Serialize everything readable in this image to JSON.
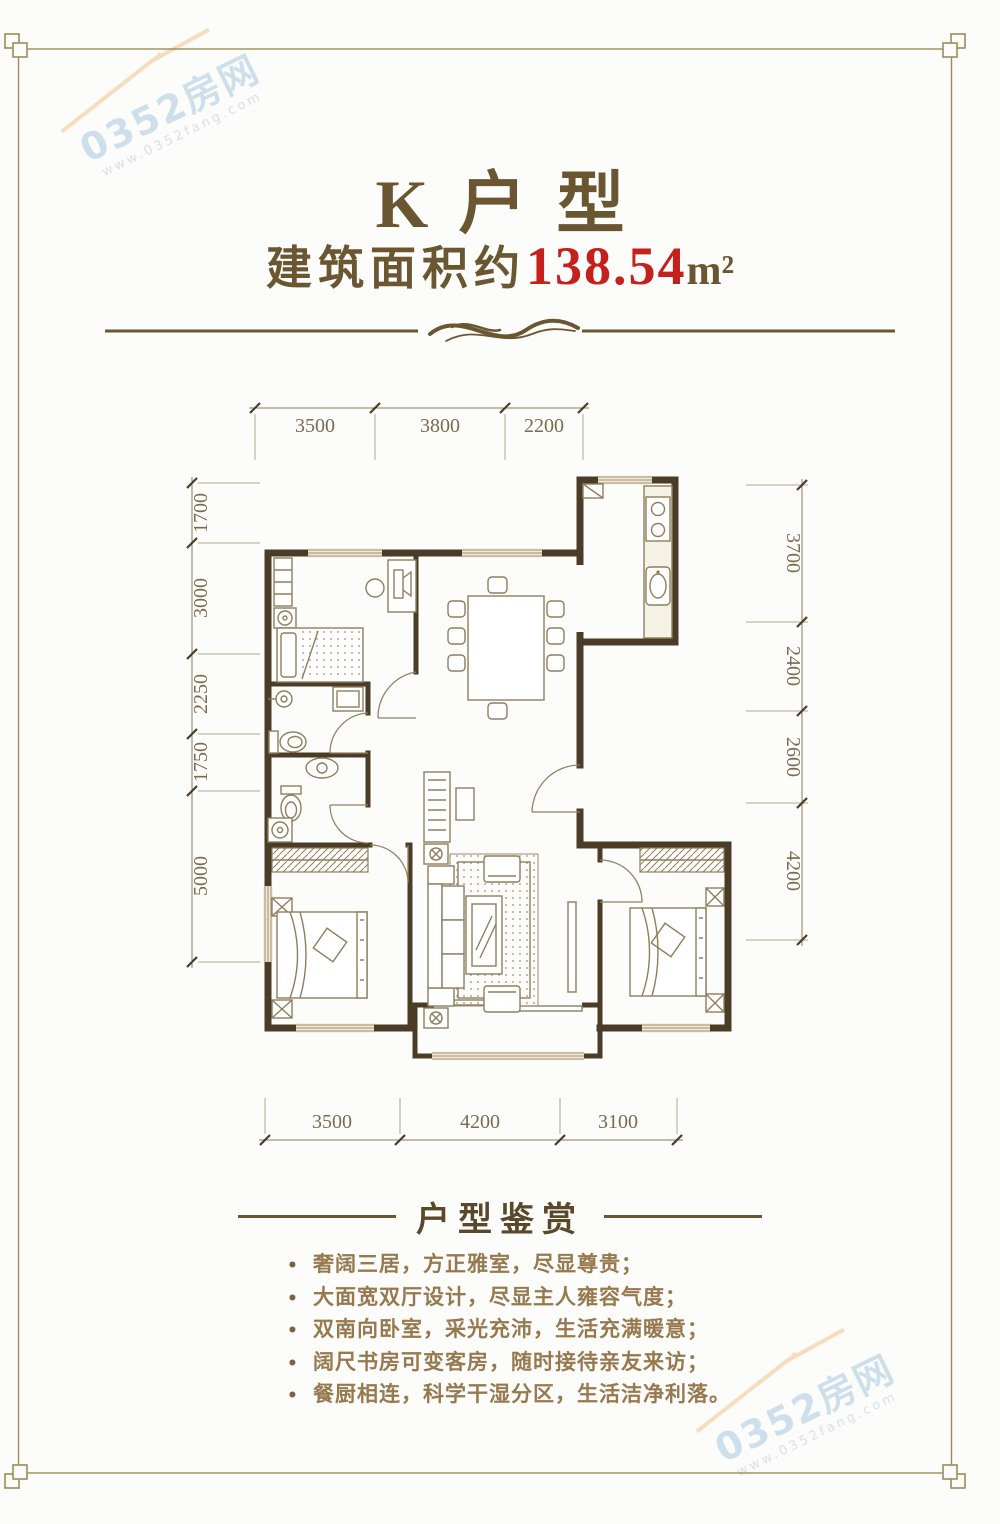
{
  "header": {
    "title": "K户型",
    "area_prefix": "建筑面积约",
    "area_value": "138.54",
    "area_unit": "m²"
  },
  "dimensions": {
    "top": [
      "3500",
      "3800",
      "2200"
    ],
    "left": [
      "1700",
      "3000",
      "2250",
      "1750",
      "5000"
    ],
    "right": [
      "3700",
      "2400",
      "2600",
      "4200"
    ],
    "bottom": [
      "3500",
      "4200",
      "3100"
    ]
  },
  "review": {
    "heading": "户型鉴赏",
    "bullet_char": "•",
    "bullets": [
      "奢阔三居，方正雅室，尽显尊贵；",
      "大面宽双厅设计，尽显主人雍容气度；",
      "双南向卧室，采光充沛，生活充满暖意；",
      "阔尺书房可变客房，随时接待亲友来访；",
      "餐厨相连，科学干湿分区，生活洁净利落。"
    ]
  },
  "watermark": {
    "brand": "0352房网",
    "url": "www.0352fang.com"
  },
  "colors": {
    "title_brown": "#6a5731",
    "area_red": "#c5201c",
    "wall": "#4a3c26",
    "frame_gold": "#9c8d58",
    "bullet_text": "#97794f",
    "watermark_blue": "#a9c9e2",
    "watermark_orange": "#f3c58c"
  }
}
